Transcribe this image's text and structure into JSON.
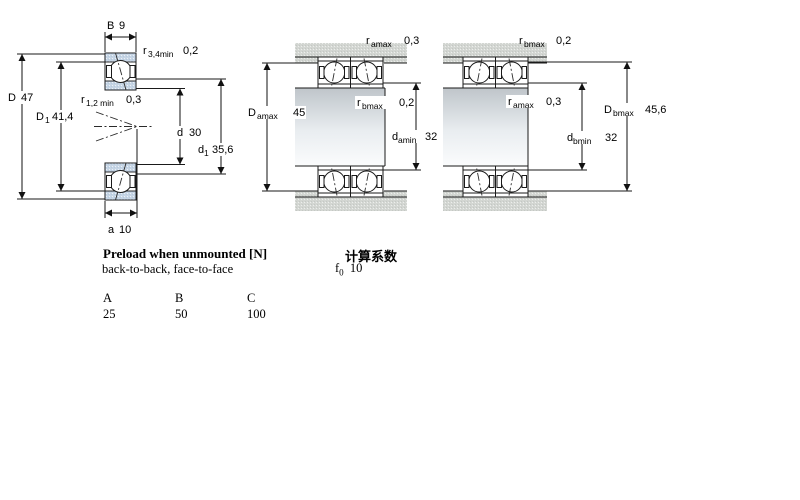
{
  "left": {
    "B": {
      "name": "B",
      "value": "9"
    },
    "r34": {
      "name": "r",
      "sub": "3,4min",
      "value": "0,2"
    },
    "D": {
      "name": "D",
      "value": "47"
    },
    "D1": {
      "name": "D",
      "sub": "1",
      "value": "41,4"
    },
    "r12": {
      "name": "r",
      "sub": "1,2 min",
      "value": "0,3"
    },
    "d": {
      "name": "d",
      "value": "30"
    },
    "d1": {
      "name": "d",
      "sub": "1",
      "value": "35,6"
    },
    "a": {
      "name": "a",
      "value": "10"
    }
  },
  "middle": {
    "r_amax": {
      "name": "r",
      "sub": "amax",
      "value": "0,3"
    },
    "D_amax": {
      "name": "D",
      "sub": "amax",
      "value": "45"
    },
    "r_bmax": {
      "name": "r",
      "sub": "bmax",
      "value": "0,2"
    },
    "d_amin": {
      "name": "d",
      "sub": "amin",
      "value": "32"
    }
  },
  "right": {
    "r_bmax": {
      "name": "r",
      "sub": "bmax",
      "value": "0,2"
    },
    "r_amax": {
      "name": "r",
      "sub": "amax",
      "value": "0,3"
    },
    "d_bmin": {
      "name": "d",
      "sub": "bmin",
      "value": "32"
    },
    "D_bmax": {
      "name": "D",
      "sub": "bmax",
      "value": "45,6"
    }
  },
  "preload": {
    "title": "Preload when unmounted [N]",
    "subtitle": "back-to-back, face-to-face",
    "columns": [
      "A",
      "B",
      "C"
    ],
    "values": [
      "25",
      "50",
      "100"
    ]
  },
  "calc": {
    "title": "计算系数",
    "factor": {
      "name": "f",
      "sub": "0",
      "value": "10"
    }
  },
  "colors": {
    "bearing_blue": "#c6d5e5",
    "steel_gray": "#d3d6d2",
    "line": "#1a1a1a"
  }
}
